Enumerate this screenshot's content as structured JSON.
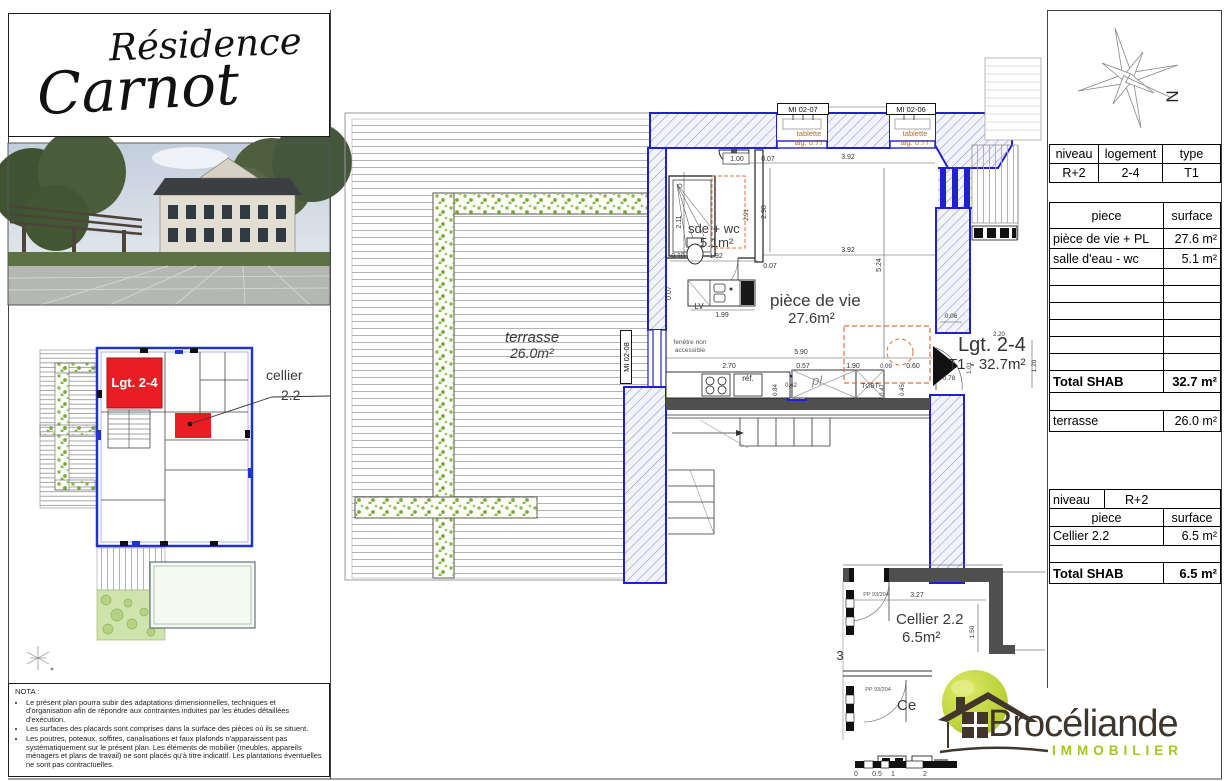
{
  "title": {
    "line1": "Résidence",
    "line2": "Carnot"
  },
  "key_plan": {
    "unit": "Lgt. 2-4",
    "cellier_line1": "cellier",
    "cellier_line2": "2.2"
  },
  "nota": {
    "title": "NOTA :",
    "bullets": [
      "Le présent plan pourra subir des adaptations dimensionnelles, techniques et d'organisation afin de répondre aux contraintes induites par les études détaillées d'exécution.",
      "Les surfaces des placards sont comprises dans la surface des pièces où ils se situent.",
      "Les poutres, poteaux, soffites, canalisations et faux plafonds n'apparaissent pas systématiquement sur le présent plan. Les éléments de mobilier (meubles, appareils ménagers et plans de travail) ne sont placés qu'à titre indicatif. Les plantations éventuelles ne sont pas contractuelles."
    ]
  },
  "plan": {
    "rooms": {
      "terrasse_name": "terrasse",
      "terrasse_area": "26.0m²",
      "piece_name": "pièce de vie",
      "piece_area": "27.6m²",
      "sde_name": "sde + wc",
      "sde_area": "5.1m²",
      "cellier_name": "Cellier 2.2",
      "cellier_area": "6.5m²"
    },
    "unit_label": "Lgt. 2-4",
    "unit_sub": "T1 - 32.7m²",
    "tags": {
      "mi0207": "MI 02-07",
      "mi0206": "MI 02-06",
      "mi0208": "MI 02-08"
    },
    "tablette": {
      "line1": "tablette",
      "line2": "alg. 0.77"
    },
    "annotations": {
      "fenetre1": "fenêtre non",
      "fenetre2": "accessible",
      "lv": "LV",
      "ref": "réf.",
      "pl": "pl",
      "tgbt": "TGBT",
      "ce": "Ce",
      "three": "3",
      "pp": "PP 93/204"
    },
    "dims": {
      "d006": "0.06",
      "d007": "0.07",
      "d009": "0.09",
      "d010": "0.10",
      "d042": "0.42",
      "d045": "0.45",
      "d047": "0.47",
      "d057": "0.57",
      "d060": "0.60",
      "d078": "0.78",
      "d084": "0.84",
      "d100": "1.00",
      "d101": "1.01",
      "d120": "1.20",
      "d150": "1.50",
      "d190": "1.90",
      "d192": "1.92",
      "d199": "1.99",
      "d211": "2.11",
      "d220": "2.20",
      "d270": "2.70",
      "d291": "2.91",
      "d298": "2.98",
      "d327": "3.27",
      "d392": "3.92",
      "d524": "5.24",
      "d590": "5.90"
    },
    "scale": {
      "s0": "0",
      "s05": "0.5",
      "s1": "1",
      "s2": "2"
    }
  },
  "compass": {
    "north": "N"
  },
  "tables": {
    "t1": {
      "headers": [
        "niveau",
        "logement",
        "type"
      ],
      "row": [
        "R+2",
        "2-4",
        "T1"
      ]
    },
    "t2": {
      "headers": [
        "piece",
        "surface"
      ],
      "rows": [
        [
          "pièce de vie + PL",
          "27.6 m²"
        ],
        [
          "salle d'eau - wc",
          "5.1 m²"
        ],
        [
          "",
          ""
        ],
        [
          "",
          ""
        ],
        [
          "",
          ""
        ],
        [
          "",
          ""
        ],
        [
          "",
          ""
        ],
        [
          "",
          ""
        ]
      ],
      "total_label": "Total SHAB",
      "total_value": "32.7 m²",
      "terrasse_label": "terrasse",
      "terrasse_value": "26.0 m²"
    },
    "t3": {
      "niveau_label": "niveau",
      "niveau_value": "R+2",
      "headers": [
        "piece",
        "surface"
      ],
      "rows": [
        [
          "Cellier 2.2",
          "6.5 m²"
        ]
      ],
      "total_label": "Total SHAB",
      "total_value": "6.5 m²"
    }
  },
  "logo": {
    "name": "Brocéliande",
    "subtitle": "IMMOBILIER"
  },
  "colors": {
    "wall_blue": "#2020cc",
    "highlight_red": "#ea1d25",
    "logo_green": "#a9c320",
    "logo_brown": "#3e352c",
    "annotation_orange": "#b26a38"
  }
}
